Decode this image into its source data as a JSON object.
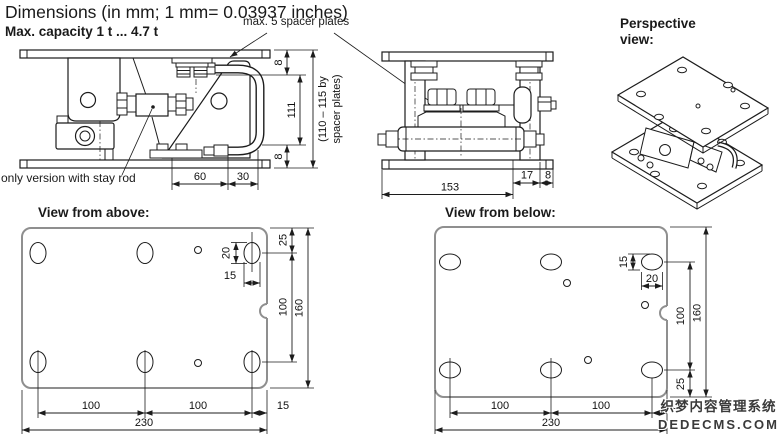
{
  "header": {
    "title": "Dimensions (in mm; 1 mm= 0.03937 inches)",
    "subtitle": "Max. capacity 1 t ... 4.7 t",
    "spacer_callout": "max. 5 spacer plates"
  },
  "front_view": {
    "note": "only version with stay rod",
    "dims": {
      "plate_top": "8",
      "height": "111",
      "plate_bottom": "8",
      "height_note_line1": "(110 – 115 by",
      "height_note_line2": "spacer plates)",
      "d60": "60",
      "d30": "30"
    }
  },
  "end_view": {
    "dims": {
      "d153": "153",
      "d17": "17",
      "d8": "8"
    }
  },
  "perspective_view": {
    "label": "Perspective view:"
  },
  "top_view": {
    "label": "View from above:",
    "dims": {
      "d25": "25",
      "d20": "20",
      "d15_slot": "15",
      "d100_v": "100",
      "d160": "160",
      "d100_a": "100",
      "d100_b": "100",
      "d15_edge": "15",
      "d230": "230"
    }
  },
  "bottom_view": {
    "label": "View from below:",
    "dims": {
      "d15_slot": "15",
      "d20": "20",
      "d100_v": "100",
      "d160": "160",
      "d25": "25",
      "d100_a": "100",
      "d100_b": "100",
      "d15_edge": "15",
      "d230": "230"
    }
  },
  "watermark": {
    "line1": "织梦内容管理系统",
    "line2": "DEDECMS.COM"
  },
  "colors": {
    "line": "#1c1c1c",
    "plate_outline": "#8f8f8f",
    "watermark_text": "#3a3a3a"
  }
}
